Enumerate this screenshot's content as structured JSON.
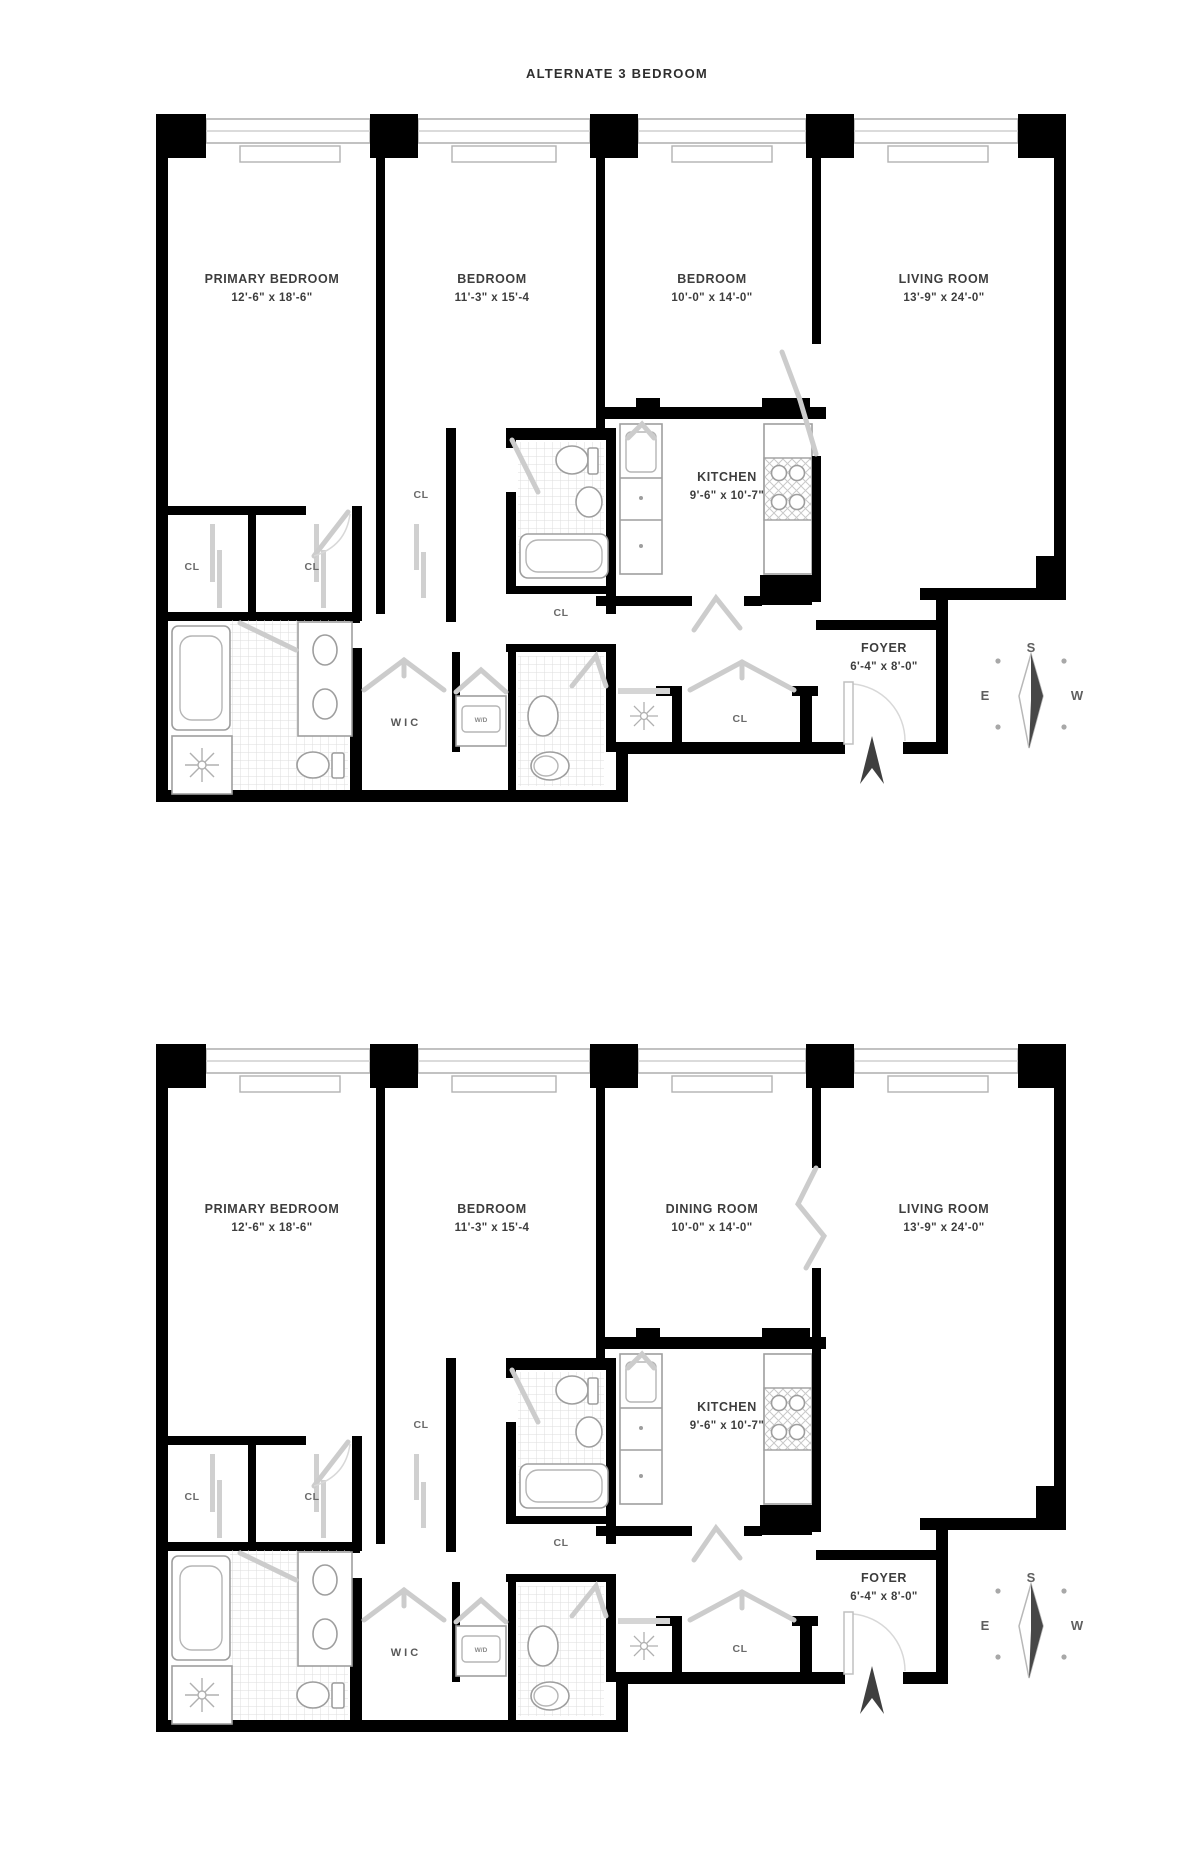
{
  "title": "ALTERNATE 3 BEDROOM",
  "plans": [
    {
      "variant": "alternate-3-bedroom-upper-plan",
      "rooms": {
        "primary_bedroom": {
          "name": "PRIMARY BEDROOM",
          "dims": "12'-6\" x 18'-6\""
        },
        "bedroom_2": {
          "name": "BEDROOM",
          "dims": "11'-3\" x 15'-4"
        },
        "room_3": {
          "name": "BEDROOM",
          "dims": "10'-0\" x 14'-0\""
        },
        "living_room": {
          "name": "LIVING ROOM",
          "dims": "13'-9\" x 24'-0\""
        },
        "kitchen": {
          "name": "KITCHEN",
          "dims": "9'-6\" x 10'-7\""
        },
        "foyer": {
          "name": "FOYER",
          "dims": "6'-4\" x 8'-0\""
        }
      },
      "labels": {
        "closet": "CL",
        "walk_in_closet": "WIC",
        "washer_dryer": "W/D"
      },
      "compass": {
        "south": "S",
        "east": "E",
        "west": "W"
      }
    },
    {
      "variant": "dining-room-lower-plan",
      "rooms": {
        "primary_bedroom": {
          "name": "PRIMARY BEDROOM",
          "dims": "12'-6\" x 18'-6\""
        },
        "bedroom_2": {
          "name": "BEDROOM",
          "dims": "11'-3\" x 15'-4"
        },
        "room_3": {
          "name": "DINING ROOM",
          "dims": "10'-0\" x 14'-0\""
        },
        "living_room": {
          "name": "LIVING ROOM",
          "dims": "13'-9\" x 24'-0\""
        },
        "kitchen": {
          "name": "KITCHEN",
          "dims": "9'-6\" x 10'-7\""
        },
        "foyer": {
          "name": "FOYER",
          "dims": "6'-4\" x 8'-0\""
        }
      },
      "labels": {
        "closet": "CL",
        "walk_in_closet": "WIC",
        "washer_dryer": "W/D"
      },
      "compass": {
        "south": "S",
        "east": "E",
        "west": "W"
      }
    }
  ],
  "colors": {
    "wall": "#000000",
    "door_swing": "#cccccc",
    "fixture_outline": "#9e9e9e",
    "label_text": "#3d3d3d",
    "secondary_text": "#6a6a6a",
    "entry_arrow": "#3f3f3f"
  }
}
